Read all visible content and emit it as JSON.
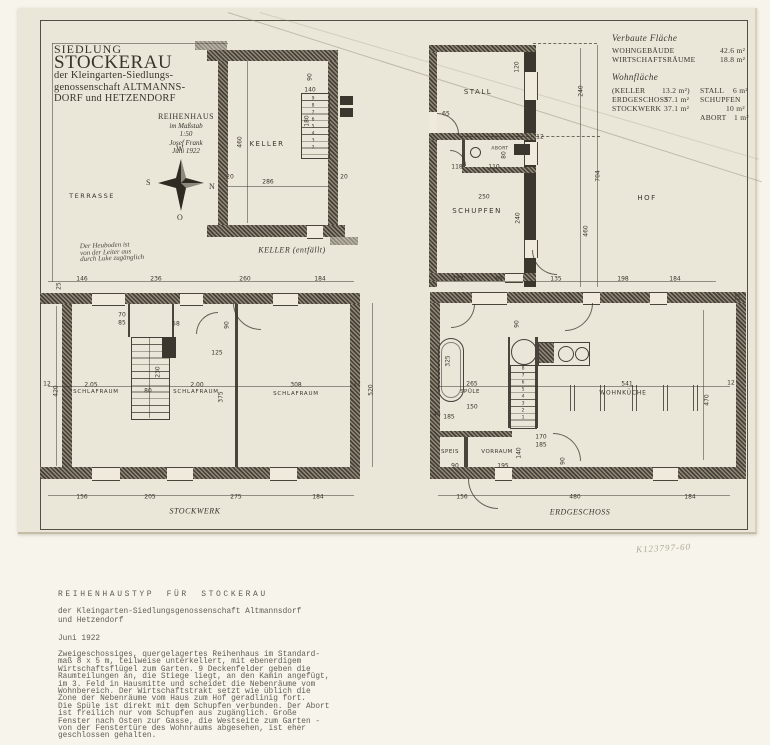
{
  "colors": {
    "paper": "#ebe7d8",
    "mount": "#f7f4eb",
    "ink": "#3a342b",
    "typewriter": "#625d55",
    "pencil": "#b2aa97"
  },
  "title_block": {
    "line1a": "SIEDLUNG",
    "line1b": "STOCKERAU",
    "line2": "der Kleingarten-Siedlungs-",
    "line3": "genossenschaft ALTMANNS-",
    "line4": "DORF und HETZENDORF",
    "sub1": "REIHENHAUS",
    "sub2": "im Maßstab",
    "sub3": "1:50",
    "sub4": "Josef Frank",
    "sub5": "Juni 1922"
  },
  "area_table": {
    "heading1": "Verbaute Fläche",
    "row1_label": "WOHNGEBÄUDE",
    "row1_value": "42.6 m²",
    "row2_label": "WIRTSCHAFTSRÄUME",
    "row2_value": "18.8 m²",
    "heading2": "Wohnfläche",
    "wf_r1l": "(KELLER",
    "wf_r1v": "13.2 m²)",
    "st_r1l": "STALL",
    "st_r1v": "6 m²",
    "wf_r2l": "ERDGESCHOSS",
    "wf_r2v": "37.1 m²",
    "st_r2l": "SCHUPFEN",
    "wf_r3l": "STOCKWERK",
    "wf_r3v": "37.1 m²",
    "st_r3v": "10 m²",
    "st_r4l": "ABORT",
    "st_r4v": "1 m²"
  },
  "compass": {
    "top": "W",
    "left": "S",
    "right": "N",
    "bottom": "O"
  },
  "note": {
    "l1": "Der Heuboden ist",
    "l2": "von der Leiter aus",
    "l3": "durch Luke zugänglich"
  },
  "inventory_no": "K123797-60",
  "room_labels": [
    {
      "t": "TERRASSE",
      "x": 92,
      "y": 196,
      "s": 6.5,
      "ls": 1.5,
      "n": "label-terrasse"
    },
    {
      "t": "KELLER",
      "x": 267,
      "y": 144,
      "s": 7,
      "ls": 1.5,
      "n": "label-keller"
    },
    {
      "t": "KELLER (entfällt)",
      "x": 292,
      "y": 250,
      "s": 8,
      "i": 1,
      "n": "caption-keller"
    },
    {
      "t": "STALL",
      "x": 478,
      "y": 92,
      "s": 7,
      "ls": 1.5,
      "n": "label-stall"
    },
    {
      "t": "ABORT",
      "x": 500,
      "y": 149,
      "s": 4.5,
      "ls": 0.4,
      "n": "label-abort"
    },
    {
      "t": "SCHUPFEN",
      "x": 477,
      "y": 211,
      "s": 7,
      "ls": 1.5,
      "n": "label-schupfen"
    },
    {
      "t": "HOF",
      "x": 647,
      "y": 198,
      "s": 7,
      "ls": 1.5,
      "n": "label-hof"
    },
    {
      "t": "SCHLAFRAUM",
      "x": 96,
      "y": 392,
      "s": 5.5,
      "ls": 0.8,
      "n": "label-schlafraum-1"
    },
    {
      "t": "SCHLAFRAUM",
      "x": 196,
      "y": 392,
      "s": 5.5,
      "ls": 0.8,
      "n": "label-schlafraum-2"
    },
    {
      "t": "SCHLAFRAUM",
      "x": 296,
      "y": 394,
      "s": 5.5,
      "ls": 0.8,
      "n": "label-schlafraum-3"
    },
    {
      "t": "STOCKWERK",
      "x": 195,
      "y": 511,
      "s": 8,
      "i": 1,
      "n": "caption-stockwerk"
    },
    {
      "t": "SPÜLE",
      "x": 470,
      "y": 392,
      "s": 5.5,
      "ls": 0.5,
      "n": "label-spuele"
    },
    {
      "t": "SPEIS",
      "x": 450,
      "y": 452,
      "s": 5.5,
      "ls": 0.5,
      "n": "label-speis"
    },
    {
      "t": "VORRAUM",
      "x": 497,
      "y": 452,
      "s": 5.5,
      "ls": 0.5,
      "n": "label-vorraum"
    },
    {
      "t": "WOHNKÜCHE",
      "x": 623,
      "y": 393,
      "s": 6,
      "ls": 0.8,
      "n": "label-wohnkueche"
    },
    {
      "t": "ERDGESCHOSS",
      "x": 580,
      "y": 512,
      "s": 8,
      "i": 1,
      "n": "caption-erdgeschoss"
    }
  ],
  "dim_labels": [
    {
      "t": "460",
      "x": 240,
      "y": 142,
      "rot": 1
    },
    {
      "t": "286",
      "x": 268,
      "y": 182
    },
    {
      "t": "20",
      "x": 230,
      "y": 177
    },
    {
      "t": "20",
      "x": 344,
      "y": 177
    },
    {
      "t": "90",
      "x": 310,
      "y": 77,
      "rot": 1
    },
    {
      "t": "140",
      "x": 310,
      "y": 90
    },
    {
      "t": "180",
      "x": 307,
      "y": 121,
      "rot": 1
    },
    {
      "t": "120",
      "x": 517,
      "y": 67,
      "rot": 1
    },
    {
      "t": "240",
      "x": 581,
      "y": 91,
      "rot": 1
    },
    {
      "t": "704",
      "x": 598,
      "y": 176,
      "rot": 1
    },
    {
      "t": "460",
      "x": 586,
      "y": 231,
      "rot": 1
    },
    {
      "t": "65",
      "x": 446,
      "y": 114
    },
    {
      "t": "118",
      "x": 457,
      "y": 167
    },
    {
      "t": "110",
      "x": 494,
      "y": 167
    },
    {
      "t": "80",
      "x": 504,
      "y": 155,
      "rot": 1
    },
    {
      "t": "250",
      "x": 484,
      "y": 197
    },
    {
      "t": "240",
      "x": 518,
      "y": 218,
      "rot": 1
    },
    {
      "t": "12",
      "x": 540,
      "y": 137
    },
    {
      "t": "146",
      "x": 82,
      "y": 279
    },
    {
      "t": "236",
      "x": 156,
      "y": 279
    },
    {
      "t": "260",
      "x": 245,
      "y": 279
    },
    {
      "t": "184",
      "x": 320,
      "y": 279
    },
    {
      "t": "25",
      "x": 59,
      "y": 286,
      "rot": 1
    },
    {
      "t": "12",
      "x": 47,
      "y": 384
    },
    {
      "t": "420",
      "x": 56,
      "y": 391,
      "rot": 1
    },
    {
      "t": "2.05",
      "x": 91,
      "y": 385
    },
    {
      "t": "80",
      "x": 148,
      "y": 391
    },
    {
      "t": "2.00",
      "x": 197,
      "y": 385
    },
    {
      "t": "308",
      "x": 296,
      "y": 385
    },
    {
      "t": "12",
      "x": 357,
      "y": 384
    },
    {
      "t": "230",
      "x": 158,
      "y": 372,
      "rot": 1
    },
    {
      "t": "375",
      "x": 221,
      "y": 397,
      "rot": 1
    },
    {
      "t": "125",
      "x": 217,
      "y": 353
    },
    {
      "t": "70",
      "x": 122,
      "y": 315
    },
    {
      "t": "85",
      "x": 122,
      "y": 323
    },
    {
      "t": "58",
      "x": 176,
      "y": 324
    },
    {
      "t": "90",
      "x": 227,
      "y": 325,
      "rot": 1
    },
    {
      "t": "520",
      "x": 371,
      "y": 390,
      "rot": 1
    },
    {
      "t": "156",
      "x": 82,
      "y": 497
    },
    {
      "t": "205",
      "x": 150,
      "y": 497
    },
    {
      "t": "275",
      "x": 236,
      "y": 497
    },
    {
      "t": "184",
      "x": 318,
      "y": 497
    },
    {
      "t": "137",
      "x": 458,
      "y": 279
    },
    {
      "t": "65",
      "x": 499,
      "y": 279
    },
    {
      "t": "135",
      "x": 556,
      "y": 279
    },
    {
      "t": "198",
      "x": 623,
      "y": 279
    },
    {
      "t": "184",
      "x": 675,
      "y": 279
    },
    {
      "t": "325",
      "x": 448,
      "y": 361,
      "rot": 1
    },
    {
      "t": "265",
      "x": 472,
      "y": 384
    },
    {
      "t": "90",
      "x": 517,
      "y": 324,
      "rot": 1
    },
    {
      "t": "150",
      "x": 472,
      "y": 407
    },
    {
      "t": "45",
      "x": 437,
      "y": 414
    },
    {
      "t": "185",
      "x": 449,
      "y": 417
    },
    {
      "t": "90",
      "x": 455,
      "y": 466
    },
    {
      "t": "195",
      "x": 503,
      "y": 466
    },
    {
      "t": "140",
      "x": 519,
      "y": 453,
      "rot": 1
    },
    {
      "t": "170",
      "x": 541,
      "y": 437
    },
    {
      "t": "185",
      "x": 541,
      "y": 445
    },
    {
      "t": "90",
      "x": 563,
      "y": 461,
      "rot": 1
    },
    {
      "t": "541",
      "x": 627,
      "y": 384
    },
    {
      "t": "470",
      "x": 707,
      "y": 400,
      "rot": 1
    },
    {
      "t": "12",
      "x": 731,
      "y": 383
    },
    {
      "t": "25",
      "x": 738,
      "y": 297,
      "rot": 1
    },
    {
      "t": "156",
      "x": 462,
      "y": 497
    },
    {
      "t": "480",
      "x": 575,
      "y": 497
    },
    {
      "t": "184",
      "x": 690,
      "y": 497
    }
  ],
  "stair_numbers": [
    {
      "t": "9",
      "x": 313,
      "y": 99
    },
    {
      "t": "8",
      "x": 313,
      "y": 106
    },
    {
      "t": "7",
      "x": 313,
      "y": 113
    },
    {
      "t": "6",
      "x": 313,
      "y": 120
    },
    {
      "t": "5",
      "x": 313,
      "y": 127
    },
    {
      "t": "4",
      "x": 313,
      "y": 134
    },
    {
      "t": "3",
      "x": 313,
      "y": 141
    },
    {
      "t": "2",
      "x": 313,
      "y": 148
    },
    {
      "t": "8",
      "x": 523,
      "y": 369
    },
    {
      "t": "7",
      "x": 523,
      "y": 376
    },
    {
      "t": "6",
      "x": 523,
      "y": 383
    },
    {
      "t": "5",
      "x": 523,
      "y": 390
    },
    {
      "t": "4",
      "x": 523,
      "y": 397
    },
    {
      "t": "3",
      "x": 523,
      "y": 404
    },
    {
      "t": "2",
      "x": 523,
      "y": 411
    },
    {
      "t": "1",
      "x": 523,
      "y": 418
    }
  ],
  "caption": {
    "title": "REIHENHAUSTYP FÜR STOCKERAU",
    "subtitle": "der Kleingarten-Siedlungsgenossenschaft Altmannsdorf\nund Hetzendorf",
    "date": "Juni 1922",
    "body": "Zweigeschossiges, quergelagertes Reihenhaus im Standard-\nmaß 8 x 5 m, teilweise unterkellert, mit ebenerdigem\nWirtschaftsflügel zum Garten. 9 Deckenfelder geben die\nRaumteilungen an, die Stiege liegt, an den Kamin angefügt,\nim 3. Feld in Hausmitte und scheidet die Nebenräume vom\nWohnbereich. Der Wirtschaftstrakt setzt wie üblich die\nZone der Nebenräume vom Haus zum Hof geradlinig fort.\nDie Spüle ist direkt mit dem Schupfen verbunden. Der Abort\nist freilich nur vom Schupfen aus zugänglich. Große\nFenster nach Osten zur Gasse, die Westseite zum Garten -\nvon der Fenstertüre des Wohnraums abgesehen, ist eher\ngeschlossen gehalten."
  }
}
